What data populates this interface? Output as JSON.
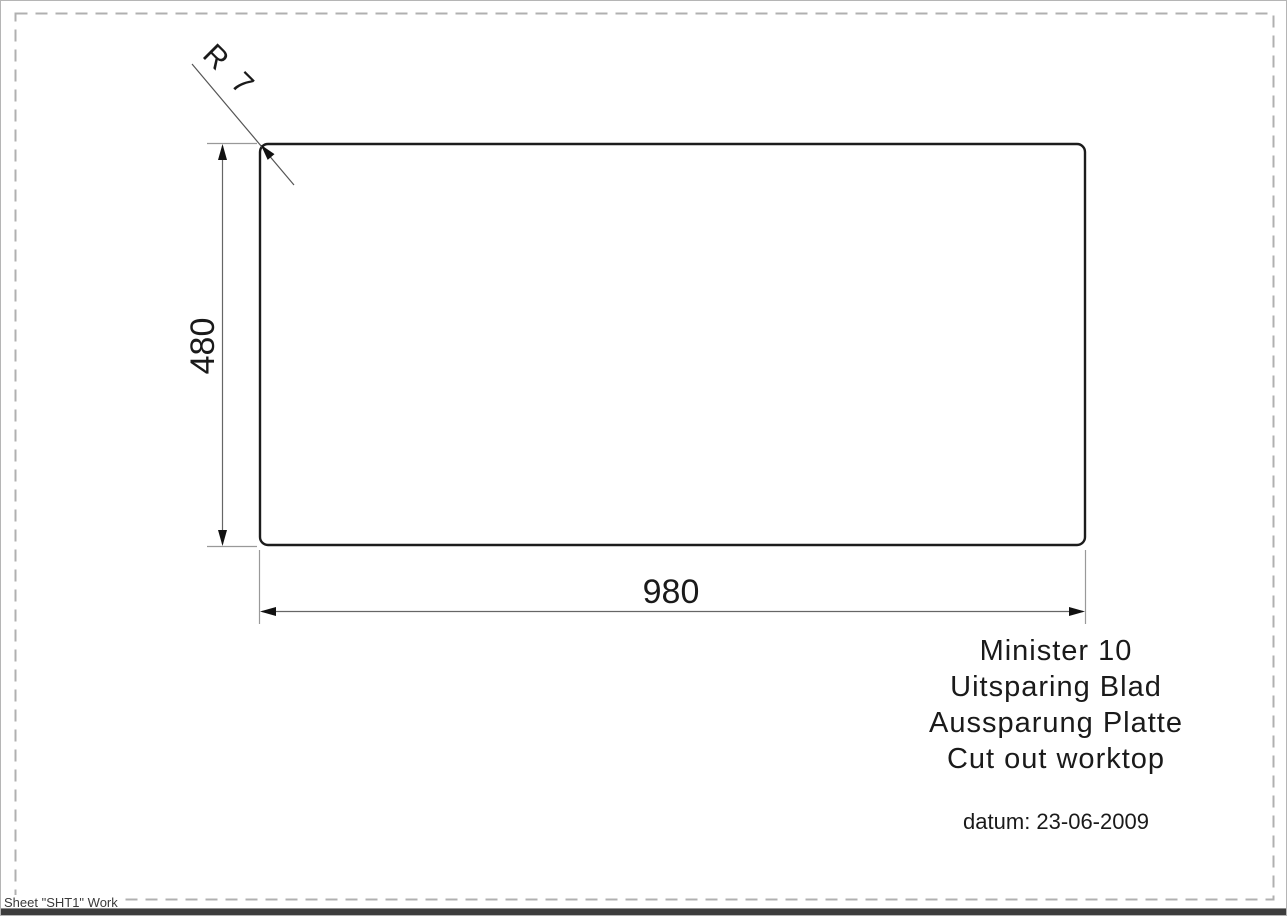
{
  "drawing": {
    "radius_label": "R 7",
    "height_dim": "480",
    "width_dim": "980"
  },
  "title_block": {
    "lines": [
      "Minister 10",
      "Uitsparing Blad",
      "Aussparung Platte",
      "Cut out worktop"
    ],
    "date": "datum: 23-06-2009"
  },
  "status": {
    "sheet_label": "Sheet \"SHT1\" Work"
  },
  "colors": {
    "drawing_line": "#1c1c1c",
    "dimension_line": "#666666",
    "extension_line": "#999999",
    "sheet_border": "#b0b0b0",
    "text": "#1a1a1a"
  }
}
